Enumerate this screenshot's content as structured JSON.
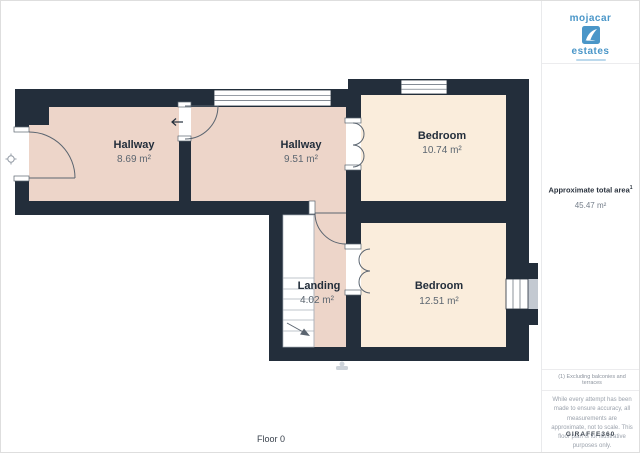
{
  "page": {
    "floor_label": "Floor 0"
  },
  "sidebar": {
    "logo_top": "mojacar",
    "logo_bottom": "estates",
    "total_area_label": "Approximate total area",
    "total_area_sup": "1",
    "total_area_value": "45.47 m²",
    "footnote": "(1) Excluding balconies and terraces",
    "disclaimer": "While every attempt has been made to ensure accuracy, all measurements are approximate, not to scale. This floor plan is for illustrative purposes only.",
    "brand": "GIRAFFE360"
  },
  "rooms": {
    "hallway1": {
      "name": "Hallway",
      "area": "8.69 m²"
    },
    "hallway2": {
      "name": "Hallway",
      "area": "9.51 m²"
    },
    "bedroom1": {
      "name": "Bedroom",
      "area": "10.74 m²"
    },
    "landing": {
      "name": "Landing",
      "area": "4.02 m²"
    },
    "bedroom2": {
      "name": "Bedroom",
      "area": "12.51 m²"
    }
  },
  "colors": {
    "wall": "#232e3b",
    "hallway_fill": "#edd5c9",
    "bedroom_fill": "#faeddc",
    "brand_blue": "#4a96c8"
  }
}
